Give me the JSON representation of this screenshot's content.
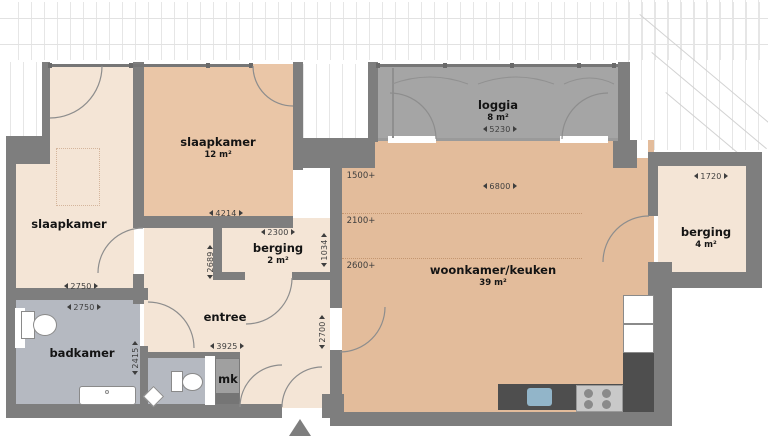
{
  "plan_type": "apartment floor plan",
  "rooms": {
    "slaapkamerLeft": {
      "label": "slaapkamer"
    },
    "slaapkamerTop": {
      "label": "slaapkamer",
      "area": "12 m²"
    },
    "loggia": {
      "label": "loggia",
      "area": "8 m²"
    },
    "bergingSmall": {
      "label": "berging",
      "area": "2 m²"
    },
    "woonkamer": {
      "label": "woonkamer/keuken",
      "area": "39 m²"
    },
    "bergingRight": {
      "label": "berging",
      "area": "4 m²"
    },
    "entree": {
      "label": "entree"
    },
    "badkamer": {
      "label": "badkamer"
    },
    "meterkast": {
      "label": "mk"
    }
  },
  "dimensions_mm": {
    "slaapkamerTopWidth": "4214",
    "slaapkamerLeftWidth": "2750",
    "badkamerWidth": "2750",
    "badkamerDepth": "2415",
    "hallDepth": "2689",
    "bergingSmallWidth": "2300",
    "bergingSmallDepth": "1034",
    "entreeWidth": "3925",
    "entreeDepth": "2700",
    "loggiaWidth": "5230",
    "woonkamerWidth": "6800",
    "bergingRightWidth": "1720"
  },
  "ceiling_heights": {
    "line1": "1500+",
    "line2": "2100+",
    "line3": "2600+"
  },
  "colors": {
    "wall": "#7e7e7e",
    "tan": "#e3bc9b",
    "tanLight": "#eac6a7",
    "cream": "#f4e5d6",
    "bath": "#b5b9c1",
    "loggia": "#a5a5a5",
    "counter": "#4e4e4e",
    "sinkBlue": "#92b5c9",
    "dimText": "#3e3e3e",
    "labelText": "#141414"
  }
}
